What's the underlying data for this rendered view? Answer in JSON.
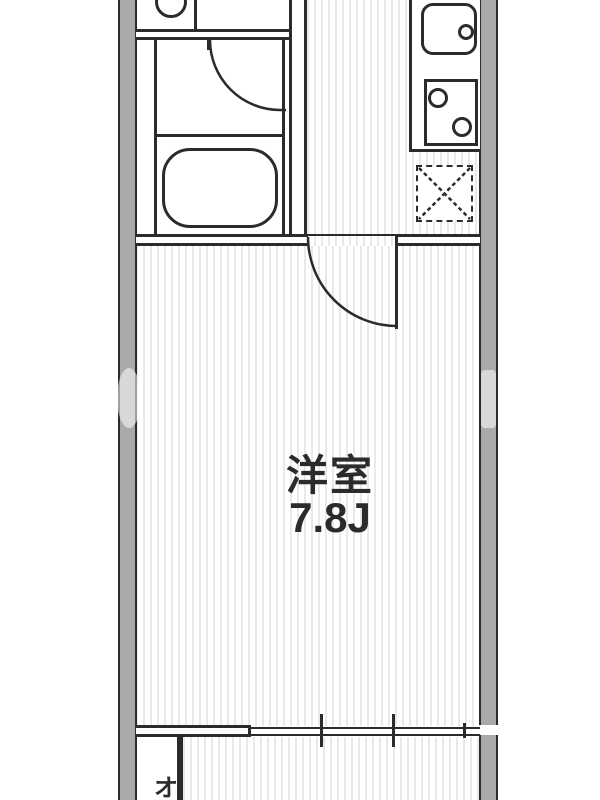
{
  "rooms": {
    "main_room": {
      "name": "洋室",
      "size": "7.8J"
    },
    "balcony": {
      "label": "オ"
    }
  },
  "fixtures": [
    {
      "name": "toilet"
    },
    {
      "name": "washroom-door"
    },
    {
      "name": "bathtub"
    },
    {
      "name": "kitchen-sink"
    },
    {
      "name": "faucet"
    },
    {
      "name": "gas-stove"
    },
    {
      "name": "washing-machine-space"
    },
    {
      "name": "room-door"
    },
    {
      "name": "sliding-window"
    }
  ],
  "colors": {
    "wall_fill": "#a9a9a9",
    "line": "#2b2b2b",
    "floor_stripe": "#e9e9e9",
    "background": "#ffffff",
    "text": "#2b2b2b"
  }
}
